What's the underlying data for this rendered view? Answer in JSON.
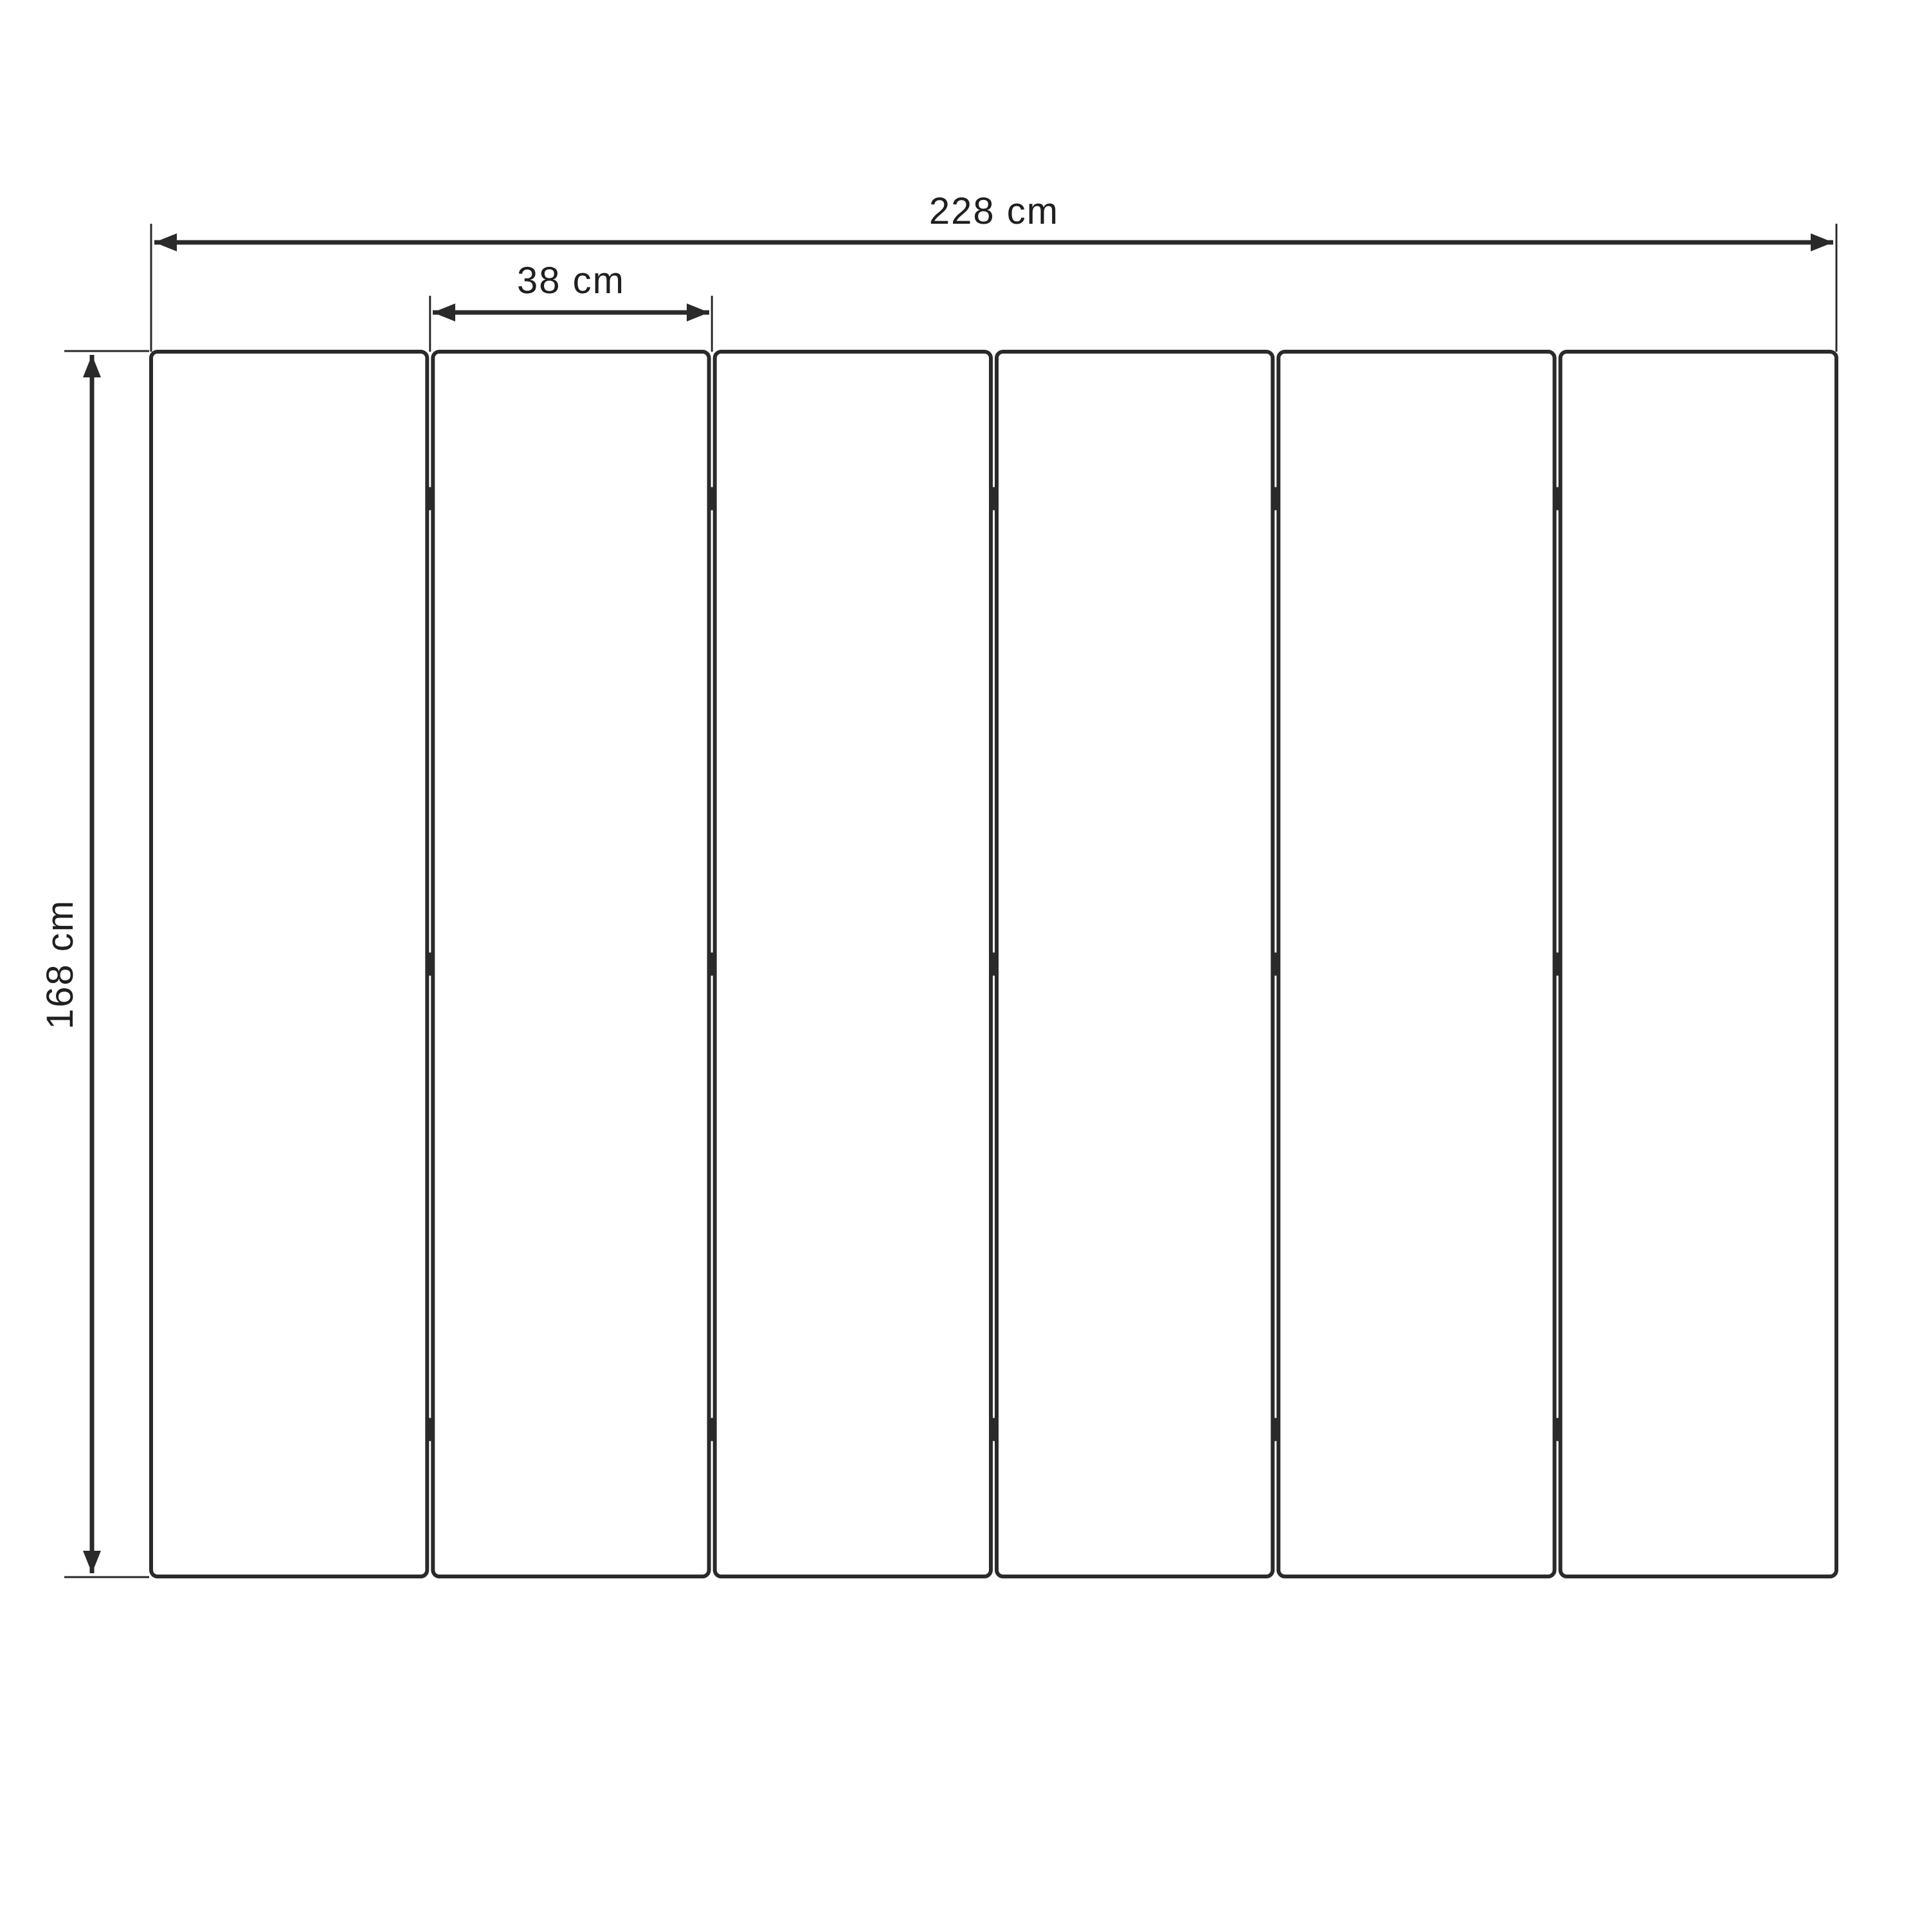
{
  "diagram": {
    "type": "technical-dimension-drawing",
    "subject": "six-panel folding screen, front elevation",
    "total_width_label": "228 cm",
    "panel_width_label": "38 cm",
    "height_label": "168 cm",
    "panel_count": 6,
    "hinge_rows": 3,
    "hinge_fractions": [
      0.12,
      0.5,
      0.88
    ],
    "measurements": {
      "total_width_cm": 228,
      "panel_width_cm": 38,
      "height_cm": 168
    }
  },
  "colors": {
    "background": "#ffffff",
    "line": "#2a2a2a",
    "text": "#1f1f1f"
  }
}
